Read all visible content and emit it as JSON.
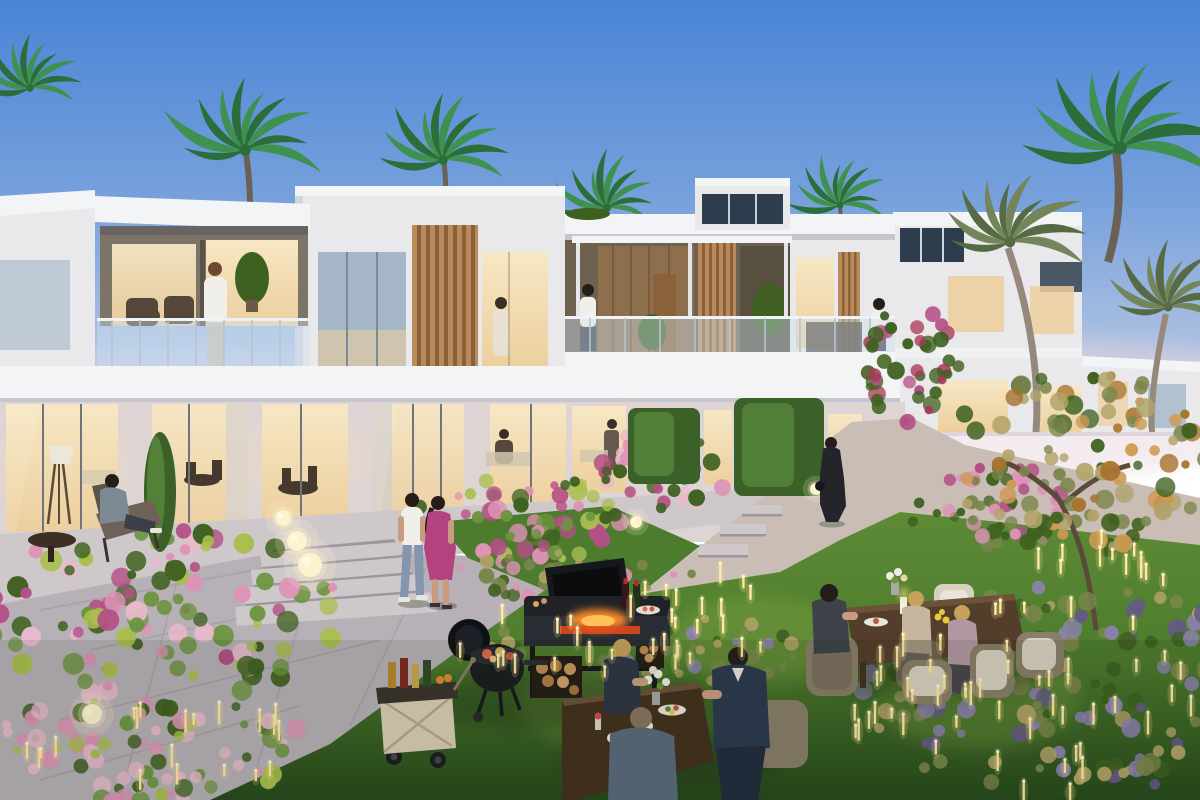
{
  "scene": {
    "type": "architectural dusk rendering",
    "description": "Twilight view of a modern white two-storey townhouse community: flat-roofed villas with timber-slat accents, glass balconies and warmly lit floor-to-ceiling windows; palm trees behind and beside the homes; landscaped gardens with pink and lavender flower beds, clipped hedges, stone pathways and steps; glowing sphere lamps and golden garden light sticks; residents relax on balconies, stroll the paths, barbecue on charcoal and gas grills beside a drinks cart, and dine at wooden tables on the lawn.",
    "time_of_day": "dusk",
    "elements": [
      "sky",
      "palm-trees",
      "townhouses",
      "roof-terrace",
      "balconies",
      "timber-slats",
      "lit-windows",
      "hedges",
      "cypress",
      "flower-beds",
      "lavender-grasses",
      "ornamental-tree",
      "stone-patio",
      "garden-steps",
      "stepping-stones",
      "curved-path",
      "lawn",
      "glow-orb-lamps",
      "light-sticks",
      "kettle-grill",
      "bbq-station",
      "firewood",
      "drinks-cart",
      "dining-tables",
      "wicker-chairs",
      "residents"
    ]
  },
  "palette": {
    "sky_top": "#4a84d6",
    "sky_mid": "#76a0dc",
    "sky_low": "#aabfe2",
    "horizon": "#dcd7e0",
    "wall": "#e9e8ea",
    "wall_shade": "#d3d5db",
    "wall_warm": "#ded4d4",
    "parapet": "#f3f4f6",
    "glass_cool": "#a4b6c8",
    "glass_night": "#2e3d4e",
    "window_warm": "#f7e7c4",
    "window_warm_deep": "#eccf9e",
    "wood": "#b98a5c",
    "wood_dark": "#8a6138",
    "wood_wall": "#8d6f4e",
    "rail_glass": "rgba(208,226,240,0.42)",
    "rail_post": "#b9c4cf",
    "hedge": "#5a8a3c",
    "hedge_dark": "#3b6128",
    "lawn": "#5c8a35",
    "lawn_mid": "#4e7c2e",
    "lawn_dark": "#27491c",
    "stone": "#b7b0b6",
    "stone_light": "#cfc8cb",
    "stone_warm": "#c9bdb6",
    "stone_dark": "#9d969d",
    "flower_magenta": "#b44f86",
    "flower_pink": "#de92b6",
    "flower_blush": "#e9bacd",
    "flower_crimson": "#a83a58",
    "leaf": "#6d9440",
    "leaf_dark": "#3f6120",
    "yellow_green": "#aabf4f",
    "lavender": "#8d81b0",
    "lavender_dark": "#645a86",
    "grass_tan": "#b2a368",
    "olive": "#7a864c",
    "amber": "#cf9a52",
    "amber_dark": "#a8742f",
    "palm_bright": "#3f9150",
    "palm_bright_dark": "#2b6e3a",
    "palm_dusk": "#73855a",
    "palm_dusk_dark": "#566b44",
    "trunk": "#96897c",
    "trunk_dark": "#6b6054",
    "orb": "#fdf2cd",
    "stick": "#ffe8a4",
    "stick_glow": "#f2d98a",
    "flame": "#ff8c2e",
    "ember": "#e64b1a",
    "table_wood": "#533d2b",
    "table_wood_dark": "#43301f",
    "wicker": "#8a7e6a",
    "cushion": "#d8d1c2",
    "cart": "#dbcfb6",
    "cart_dark": "#39342c",
    "navy": "#2c3950",
    "white_shirt": "#f1efe9",
    "magenta_dress": "#b3437f",
    "beige": "#c7b69e",
    "mauve": "#b197a1",
    "denim": "#8396ae",
    "black_outfit": "#24252b",
    "furniture": "#45392e",
    "skin": "#c99c80",
    "skin_dark": "#6e4a33",
    "blonde": "#c7a05a",
    "hair_dark": "#241d18"
  }
}
